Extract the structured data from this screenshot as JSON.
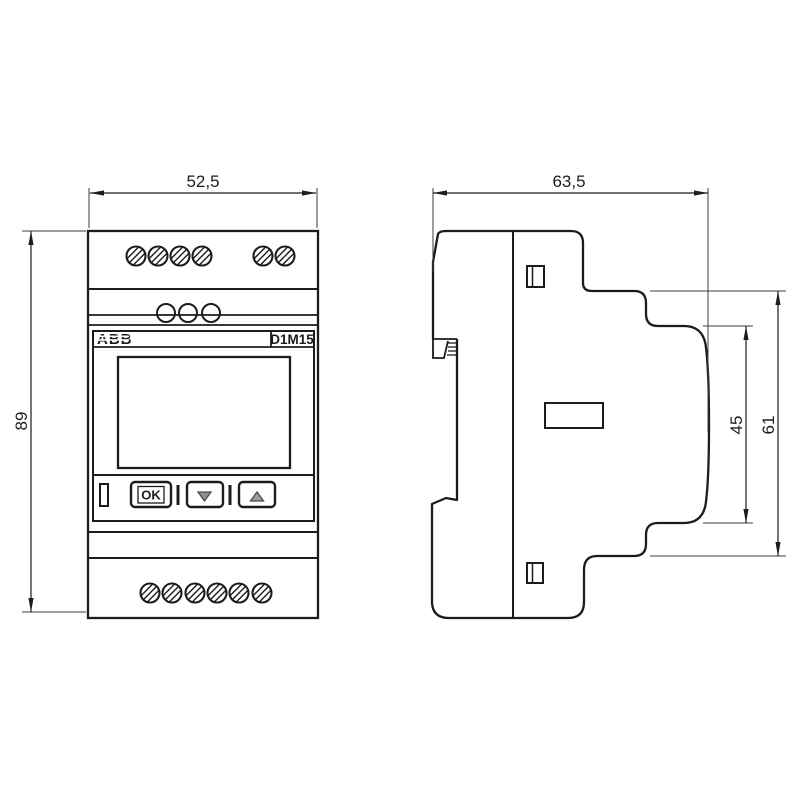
{
  "meta": {
    "brand": "ABB",
    "model": "D1M15",
    "drawing_type": "dimensional drawing, front and side view"
  },
  "front_view": {
    "buttons": {
      "ok": "OK"
    },
    "icons": [
      "down-arrow-icon",
      "up-arrow-icon"
    ],
    "terminals": {
      "top_left_screws": 4,
      "top_right_screws": 2,
      "mid_holes": 3,
      "bottom_screws": 6
    }
  },
  "dimensions": {
    "width": "52,5",
    "height": "89",
    "depth": "63,5",
    "inner_height": "45",
    "outer_height": "61"
  },
  "colors": {
    "line": "#1c1c1c",
    "thin_line": "#3c3c3c",
    "background": "#ffffff",
    "button_triangle": "#8f8f8f"
  }
}
